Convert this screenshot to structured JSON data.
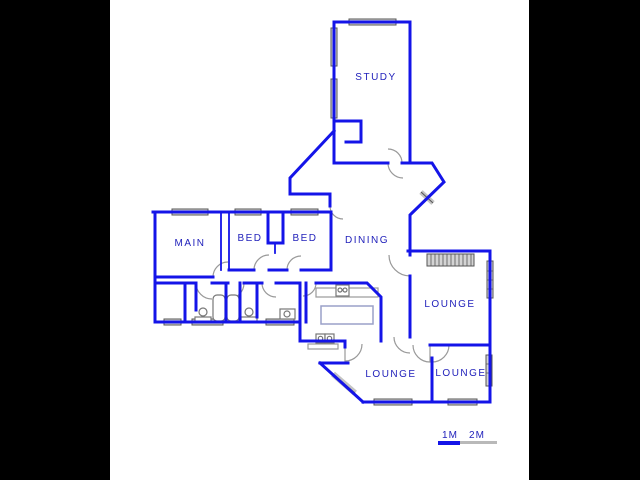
{
  "rooms": [
    {
      "label": "STUDY"
    },
    {
      "label": "MAIN"
    },
    {
      "label": "BED"
    },
    {
      "label": "BED"
    },
    {
      "label": "DINING"
    },
    {
      "label": "LOUNGE"
    },
    {
      "label": "LOUNGE"
    },
    {
      "label": "LOUNGE"
    }
  ],
  "scale": {
    "m1": "1M",
    "m2": "2M"
  },
  "colors": {
    "matte": "#000000",
    "background": "#ffffff",
    "wall": "#1414e8",
    "label": "#2222bb",
    "winfill": "#d4d4d4",
    "winstroke": "#555555",
    "door": "#999999",
    "fixture": "#777777",
    "island": "#9aa0c8",
    "scaleblue": "#1414e8",
    "scalegray": "#b9b9b9"
  }
}
